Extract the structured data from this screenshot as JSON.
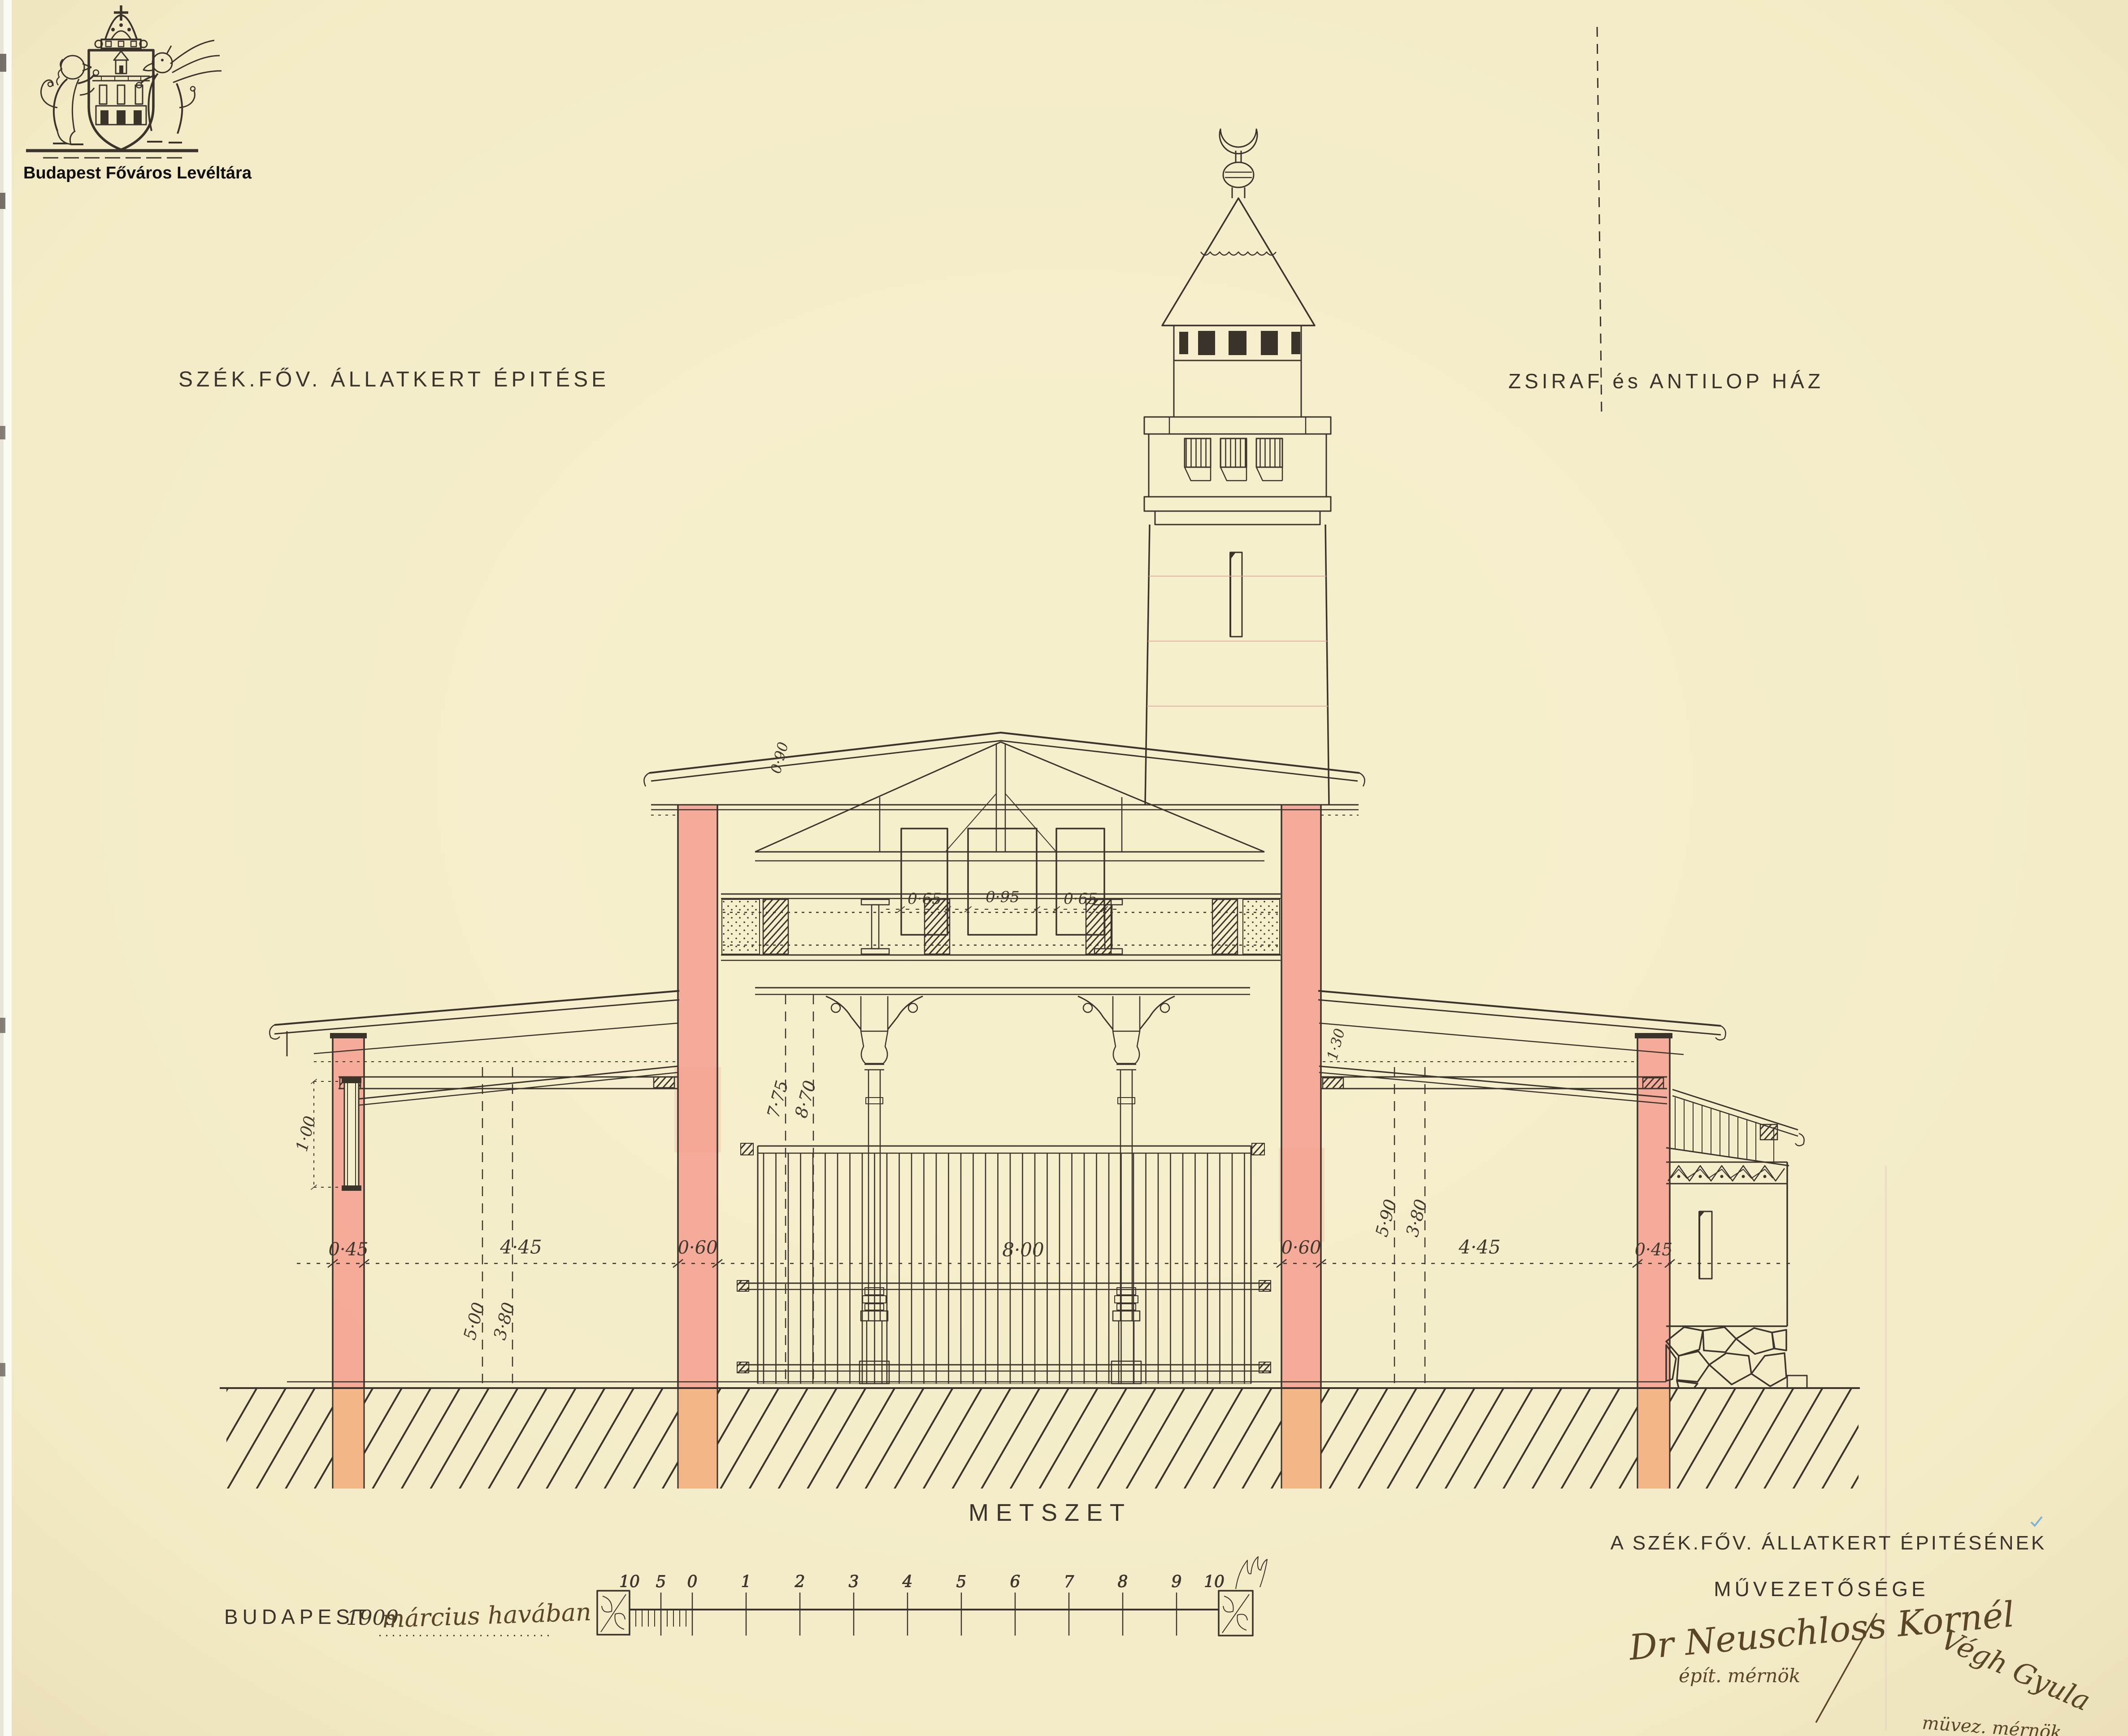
{
  "archive_stamp": {
    "name": "Budapest Főváros Levéltára"
  },
  "titles": {
    "project": "SZÉK.FŐV. ÁLLATKERT ÉPITÉSE",
    "building": "ZSIRAF és ANTILOP HÁZ",
    "drawing_type": "METSZET"
  },
  "dimensions": {
    "ground_line": [
      "0·45",
      "4·45",
      "0·60",
      "8·00",
      "0·60",
      "4·45",
      "0·45"
    ],
    "clerestory_widths": [
      "0·65",
      "0·95",
      "0·65"
    ],
    "hall_heights": [
      "7·75",
      "8·70"
    ],
    "left_wing_heights": [
      "5·00",
      "3·80"
    ],
    "right_wing_heights": [
      "5·90",
      "3·80"
    ],
    "left_window_height": "1·00",
    "eave_height": "0·90",
    "clerestory_height": "1·30"
  },
  "scale_bar": {
    "labels": [
      "10",
      "5",
      "0",
      "1",
      "2",
      "3",
      "4",
      "5",
      "6",
      "7",
      "8",
      "9",
      "10"
    ]
  },
  "date_line": {
    "printed": "BUDAPEST",
    "year": "1909",
    "handwritten": "március havában"
  },
  "office_block": {
    "line1": "A SZÉK.FŐV. ÁLLATKERT ÉPITÉSÉNEK",
    "line2": "MŰVEZETŐSÉGE"
  },
  "signatures": {
    "architect_name": "Dr Neuschloss Kornél",
    "architect_title": "épít. mérnök",
    "engineer_name": "Végh Gyula",
    "engineer_title": "müvez. mérnök"
  },
  "colors": {
    "paper": "#f6efcc",
    "ink": "#3b342b",
    "wall_section_red": "#f59a8c",
    "footing_orange": "#f3ab79",
    "pencil_red": "#dba79e"
  }
}
